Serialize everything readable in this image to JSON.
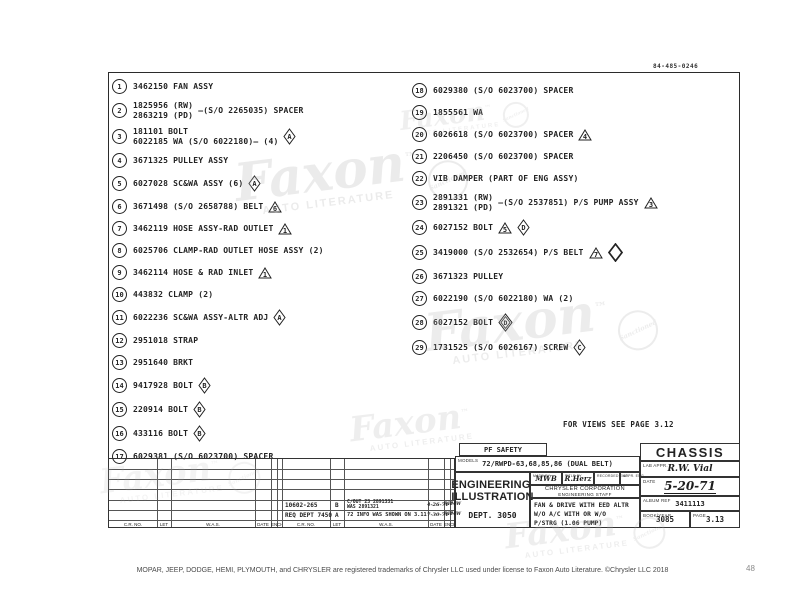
{
  "page": {
    "corner_code": "84-485-0246",
    "views_note": "FOR VIEWS SEE PAGE 3.12",
    "footer_text": "MOPAR, JEEP, DODGE, HEMI, PLYMOUTH, and CHRYSLER are registered trademarks of Chrysler LLC used under license to Faxon Auto Literature. ©Chrysler LLC 2018",
    "page_number": "48"
  },
  "watermark": {
    "name": "Faxon",
    "tm": "™",
    "subtitle": "AUTO LITERATURE",
    "badge": "Sanctioned"
  },
  "parts": {
    "left": [
      {
        "num": "1",
        "lines": [
          "3462150 FAN ASSY"
        ]
      },
      {
        "num": "2",
        "lines": [
          "1825956 (RW)",
          "2863219 (PD)"
        ],
        "suffix": "—(S/O 2265035) SPACER"
      },
      {
        "num": "3",
        "lines": [
          "181101 BOLT",
          "6022185 WA (S/O 6022180)—  (4)"
        ],
        "syms": [
          {
            "t": "dia",
            "v": "A"
          }
        ]
      },
      {
        "num": "4",
        "lines": [
          "3671325 PULLEY ASSY"
        ]
      },
      {
        "num": "5",
        "lines": [
          "6027028 SC&WA ASSY  (6)"
        ],
        "syms": [
          {
            "t": "dia",
            "v": "A"
          }
        ]
      },
      {
        "num": "6",
        "lines": [
          "3671498 (S/O 2658788) BELT"
        ],
        "syms": [
          {
            "t": "tri",
            "v": "6"
          }
        ]
      },
      {
        "num": "7",
        "lines": [
          "3462119 HOSE ASSY-RAD OUTLET"
        ],
        "syms": [
          {
            "t": "tri",
            "v": "1"
          }
        ]
      },
      {
        "num": "8",
        "lines": [
          "6025706 CLAMP-RAD OUTLET HOSE ASSY  (2)"
        ]
      },
      {
        "num": "9",
        "lines": [
          "3462114 HOSE & RAD INLET"
        ],
        "syms": [
          {
            "t": "tri",
            "v": "1"
          }
        ]
      },
      {
        "num": "10",
        "lines": [
          "443832 CLAMP  (2)"
        ]
      },
      {
        "num": "11",
        "lines": [
          "6022236 SC&WA ASSY-ALTR ADJ"
        ],
        "syms": [
          {
            "t": "dia",
            "v": "A"
          }
        ]
      },
      {
        "num": "12",
        "lines": [
          "2951018 STRAP"
        ]
      },
      {
        "num": "13",
        "lines": [
          "2951640 BRKT"
        ]
      },
      {
        "num": "14",
        "lines": [
          "9417928 BOLT"
        ],
        "syms": [
          {
            "t": "dia",
            "v": "B"
          }
        ]
      },
      {
        "num": "15",
        "lines": [
          "220914 BOLT"
        ],
        "syms": [
          {
            "t": "dia",
            "v": "B"
          }
        ]
      },
      {
        "num": "16",
        "lines": [
          "433116 BOLT"
        ],
        "syms": [
          {
            "t": "dia",
            "v": "B"
          }
        ]
      },
      {
        "num": "17",
        "lines": [
          "6029381 (S/O 6023700) SPACER"
        ]
      }
    ],
    "right": [
      {
        "num": "18",
        "lines": [
          "6029380 (S/O 6023700) SPACER"
        ]
      },
      {
        "num": "19",
        "lines": [
          "1855561 WA"
        ]
      },
      {
        "num": "20",
        "lines": [
          "6026618 (S/O 6023700) SPACER"
        ],
        "syms": [
          {
            "t": "tri",
            "v": "4"
          }
        ]
      },
      {
        "num": "21",
        "lines": [
          "2206450 (S/O 6023700) SPACER"
        ]
      },
      {
        "num": "22",
        "lines": [
          "VIB DAMPER (PART OF ENG ASSY)"
        ]
      },
      {
        "num": "23",
        "lines": [
          "2891331 (RW)",
          "2891321 (PD)"
        ],
        "suffix": "—(S/O 2537851) P/S PUMP ASSY",
        "syms": [
          {
            "t": "tri",
            "v": "3"
          }
        ]
      },
      {
        "num": "24",
        "lines": [
          "6027152 BOLT"
        ],
        "syms": [
          {
            "t": "tri",
            "v": "5"
          },
          {
            "t": "dia",
            "v": "D"
          }
        ]
      },
      {
        "num": "25",
        "lines": [
          "3419000 (S/O 2532654) P/S BELT"
        ],
        "syms": [
          {
            "t": "tri",
            "v": "7"
          },
          {
            "t": "dbig",
            "v": ""
          }
        ]
      },
      {
        "num": "26",
        "lines": [
          "3671323 PULLEY"
        ]
      },
      {
        "num": "27",
        "lines": [
          "6022190 (S/O 6022180) WA  (2)"
        ]
      },
      {
        "num": "28",
        "lines": [
          "6027152 BOLT"
        ],
        "syms": [
          {
            "t": "ddia",
            "v": "D"
          }
        ]
      },
      {
        "num": "29",
        "lines": [
          "1731525 (S/O 6026167) SCREW"
        ],
        "syms": [
          {
            "t": "dia",
            "v": "C"
          }
        ]
      }
    ]
  },
  "title_block": {
    "pf_safety": "PF SAFETY",
    "models_label": "MODELS",
    "models": "72/RWPD-63,68,85,86 (DUAL BELT)",
    "dept_name_1": "ENGINEERING",
    "dept_name_2": "ILLUSTRATION",
    "dept": "DEPT. 3050",
    "sig_1_label": "MADE BY",
    "sig_1": "MWB",
    "sig_2_label": "TITLE BY",
    "sig_2": "R.Herz",
    "sig_3_label": "RECORDED ENG.",
    "sig_4_label": "APPR. ENG.",
    "company_1": "CHRYSLER CORPORATION",
    "company_2": "ENGINEERING STAFF",
    "description": [
      "FAN & DRIVE WITH EED ALTR",
      "W/O A/C WITH OR W/O",
      "P/STRG (1.06 PUMP)"
    ],
    "chassis": "CHASSIS",
    "lab_appr_label": "LAB APPR.",
    "lab_appr_sig": "R.W. Vial",
    "date_label": "DATE",
    "date": "5-20-71",
    "album_label": "ALBUM REF",
    "album": "3411113",
    "book_label": "BOOK/YEAR",
    "book": "3085",
    "page_label": "PAGE",
    "page": "3.13"
  },
  "revision_table": {
    "col_headers": [
      "C.R. NO.",
      "LET",
      "W.A.S.",
      "DATE",
      "ENGR",
      "CH"
    ],
    "entries": [
      {
        "cr_no": "10602-265",
        "let": "B",
        "was_1": "C/OUT 23 2891331",
        "was_2": "WAS 2891321",
        "date": "4-26-71",
        "engr": "RH",
        "ch": "MW"
      },
      {
        "cr_no": "REQ DEPT 7450",
        "let": "A",
        "was_1": "72 INFO WAS SHOWN ON 3.11",
        "was_2": "",
        "date": "7-30-71",
        "engr": "RH",
        "ch": "MW"
      }
    ]
  }
}
